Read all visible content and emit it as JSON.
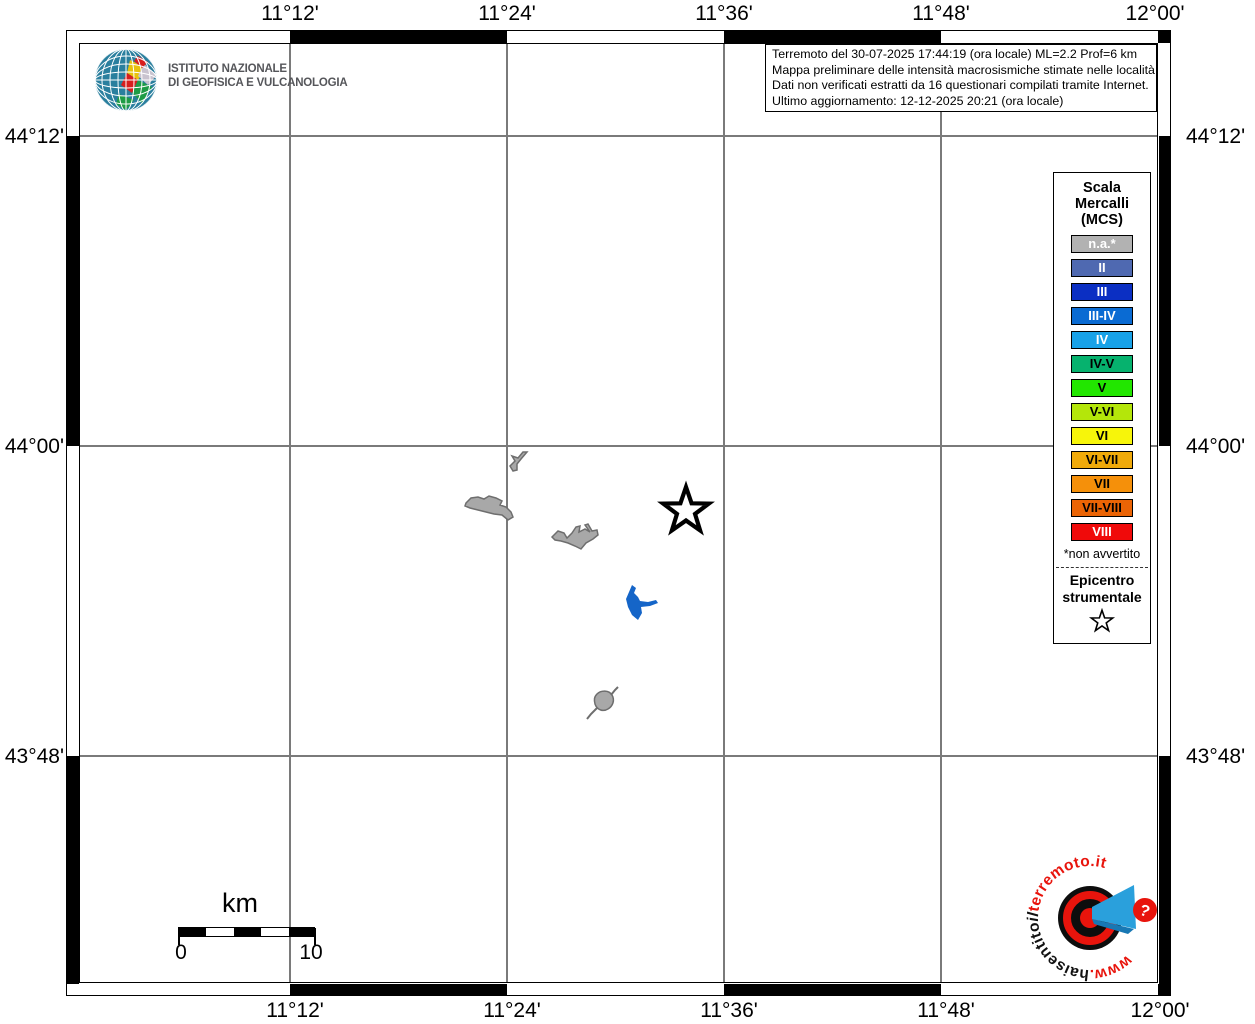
{
  "header": {
    "ingv_logo": {
      "line1": "ISTITUTO NAZIONALE",
      "line2": "DI GEOFISICA E VULCANOLOGIA"
    },
    "info_box": {
      "lines": [
        "Terremoto del 30-07-2025 17:44:19 (ora locale) ML=2.2 Prof=6 km",
        "Mappa preliminare delle intensità macrosismiche stimate nelle località",
        "Dati non verificati estratti da 16 questionari compilati tramite Internet.",
        "Ultimo aggiornamento: 12-12-2025 20:21 (ora locale)"
      ]
    }
  },
  "axes": {
    "top": [
      "11°12'",
      "11°24'",
      "11°36'",
      "11°48'",
      "12°00'"
    ],
    "bottom": [
      "11°12'",
      "11°24'",
      "11°36'",
      "11°48'",
      "12°00'"
    ],
    "left": [
      "44°12'",
      "44°00'",
      "43°48'"
    ],
    "right": [
      "44°12'",
      "44°00'",
      "43°48'"
    ]
  },
  "legend": {
    "title_lines": [
      "Scala",
      "Mercalli",
      "(MCS)"
    ],
    "items": [
      {
        "label": "n.a.*",
        "color": "#b2b2b2",
        "text_color": "#ffffff"
      },
      {
        "label": "II",
        "color": "#4f69b1",
        "text_color": "#ffffff"
      },
      {
        "label": "III",
        "color": "#0b2fc3",
        "text_color": "#ffffff"
      },
      {
        "label": "III-IV",
        "color": "#0a6bd3",
        "text_color": "#ffffff"
      },
      {
        "label": "IV",
        "color": "#18a2e8",
        "text_color": "#ffffff"
      },
      {
        "label": "IV-V",
        "color": "#06b26e",
        "text_color": "#000000"
      },
      {
        "label": "V",
        "color": "#22e600",
        "text_color": "#000000"
      },
      {
        "label": "V-VI",
        "color": "#b4e60a",
        "text_color": "#000000"
      },
      {
        "label": "VI",
        "color": "#f7f50a",
        "text_color": "#000000"
      },
      {
        "label": "VI-VII",
        "color": "#f0aa0a",
        "text_color": "#000000"
      },
      {
        "label": "VII",
        "color": "#f5900a",
        "text_color": "#000000"
      },
      {
        "label": "VII-VIII",
        "color": "#eb6405",
        "text_color": "#000000"
      },
      {
        "label": "VIII",
        "color": "#f00a0a",
        "text_color": "#ffffff"
      }
    ],
    "footnote": "*non avvertito",
    "epicenter_label_lines": [
      "Epicentro",
      "strumentale"
    ]
  },
  "scale_bar": {
    "unit": "km",
    "start": "0",
    "end": "10"
  },
  "site_logo": {
    "text_www": "www.",
    "text_hai": "haisentito",
    "text_il": "il",
    "text_terremoto": "terremoto.it",
    "question_mark": "?",
    "red": "#e8140c",
    "blue": "#2aa0dc"
  },
  "map": {
    "land_color": "#a8a8a8",
    "land_outline": "#6e6e6e",
    "lake_color": "#1565c8",
    "grid_color": "#7a7a7a",
    "epicenter_fill": "#ffffff",
    "epicenter_stroke": "#000000"
  }
}
